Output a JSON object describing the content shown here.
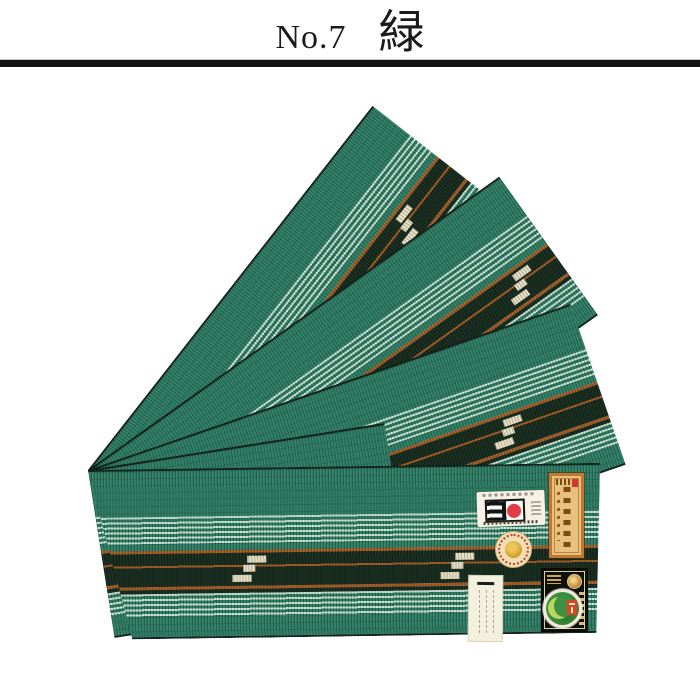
{
  "header": {
    "number": "No.7",
    "color_name": "緑"
  },
  "divider": {
    "color": "#101010"
  },
  "photo": {
    "subject": "green striped obi sashes fanned out",
    "strip_count": 5,
    "fabric": {
      "palette": {
        "green": "#2e7d64",
        "mint_stripe": "#c9e4d4",
        "dark_band": "#16291c",
        "rust_line": "#a85a22",
        "kasuri_cream": "#e9e0c4",
        "edge": "#0e2017"
      }
    },
    "labels": {
      "maker_card": {
        "icon": "rising-sun-logo-icon",
        "bg": "#f6f1e3",
        "sun_red": "#e23b47"
      },
      "gold_tag": {
        "icon": "calligraphy-tag-icon",
        "bg": "#e9c07b",
        "border": "#bd7834",
        "seal_red": "#cf3a2e"
      },
      "round_seal": {
        "icon": "round-seal-sticker-icon",
        "bg": "#eedfb6",
        "ring_red": "#c23f2e",
        "center_gold": "#d8a62e"
      },
      "cert_label": {
        "icon": "certification-label-icon",
        "bg": "#10100a",
        "coin_gold": "#c98f3c",
        "sticker_green": "#3d8f41",
        "sticker_leaf": "#b8d75c",
        "mark_orange": "#e0441c"
      },
      "paper_tag": {
        "icon": "paper-price-tag-icon",
        "bg": "#f4f0de"
      }
    }
  }
}
